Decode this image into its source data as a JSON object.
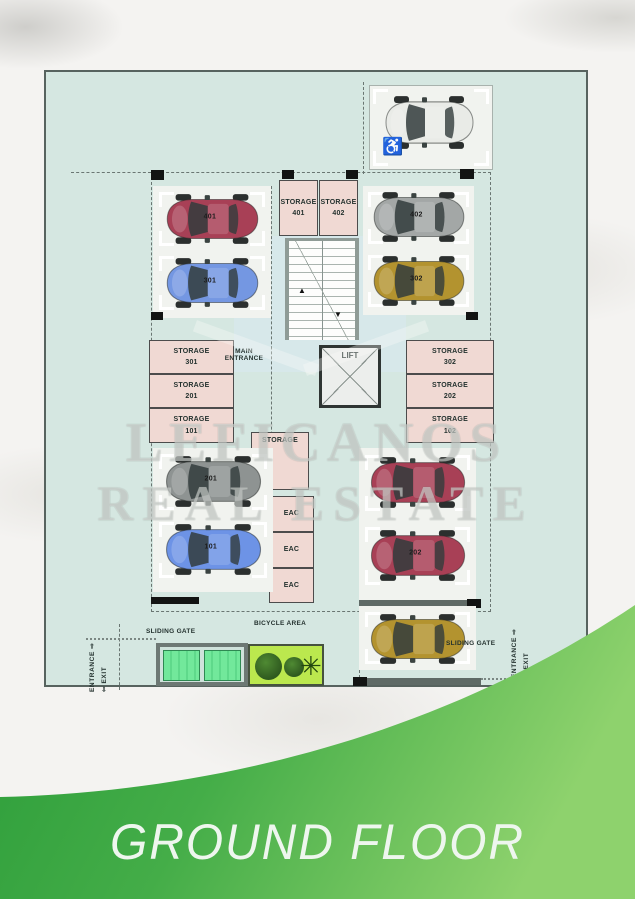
{
  "banner": {
    "title": "GROUND FLOOR",
    "green_dark": "#2b9c39",
    "green_light": "#8ed26d"
  },
  "watermark": {
    "line1": "LEFICANOS",
    "line2": "REAL ESTATE"
  },
  "colors": {
    "plan_bg": "#d5e7e1",
    "storage_fill": "#f0d9d3",
    "gate_green": "#72e89b",
    "planter_green": "#bbe84e"
  },
  "plan": {
    "lift": "LIFT",
    "main_entrance_line1": "MAIN",
    "main_entrance_line2": "ENTRANCE",
    "storage_center": "STORAGE",
    "bicycle_area": "BICYCLE AREA",
    "sliding_gate": "SLIDING GATE",
    "entrance_label": "ENTRANCE ⇨",
    "exit_label": "⇦ EXIT",
    "accessible_icon": "♿",
    "stairs_up_arrow": "▲",
    "stairs_down_arrow": "▼",
    "eac_rooms": [
      "EAC",
      "EAC",
      "EAC"
    ],
    "storages": [
      {
        "line1": "STORAGE",
        "line2": "401"
      },
      {
        "line1": "STORAGE",
        "line2": "402"
      },
      {
        "line1": "STORAGE",
        "line2": "301"
      },
      {
        "line1": "STORAGE",
        "line2": "201"
      },
      {
        "line1": "STORAGE",
        "line2": "101"
      },
      {
        "line1": "STORAGE",
        "line2": "302"
      },
      {
        "line1": "STORAGE",
        "line2": "202"
      },
      {
        "line1": "STORAGE",
        "line2": "102"
      }
    ],
    "cars": [
      {
        "id": "car-401",
        "label": "401",
        "color": "#a84056"
      },
      {
        "id": "car-301",
        "label": "301",
        "color": "#7497e2"
      },
      {
        "id": "car-402",
        "label": "402",
        "color": "#a3a7a6"
      },
      {
        "id": "car-302",
        "label": "302",
        "color": "#b3932f"
      },
      {
        "id": "car-201",
        "label": "201",
        "color": "#8e9392"
      },
      {
        "id": "car-101",
        "label": "101",
        "color": "#6d93e6"
      },
      {
        "id": "car-lower-right-1",
        "label": "",
        "color": "#a84056"
      },
      {
        "id": "car-202",
        "label": "202",
        "color": "#a84056"
      },
      {
        "id": "car-lower-right-gold",
        "label": "",
        "color": "#b3932f"
      },
      {
        "id": "car-accessible",
        "label": "",
        "color": "#e9ebe7"
      }
    ]
  }
}
